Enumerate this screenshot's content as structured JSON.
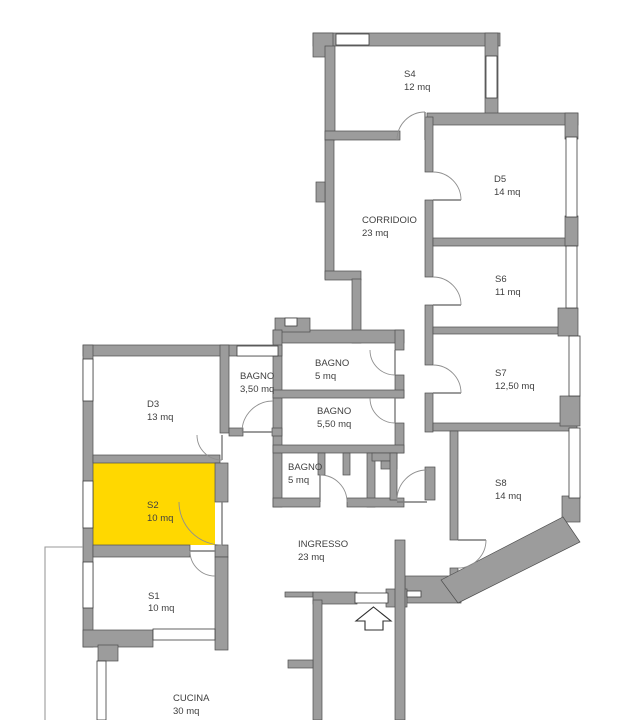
{
  "title": "Planimetria appartamento",
  "colors": {
    "wall": "#9c9c9c",
    "highlight": "#ffd800",
    "background": "#ffffff"
  },
  "highlighted_room": "S2",
  "unit_label": "mq",
  "rooms": [
    {
      "id": "s4",
      "name": "S4",
      "area": "12 mq"
    },
    {
      "id": "corridoio",
      "name": "CORRIDOIO",
      "area": "23 mq"
    },
    {
      "id": "d5",
      "name": "D5",
      "area": "14 mq"
    },
    {
      "id": "s6",
      "name": "S6",
      "area": "11 mq"
    },
    {
      "id": "s7",
      "name": "S7",
      "area": "12,50 mq"
    },
    {
      "id": "s8",
      "name": "S8",
      "area": "14 mq"
    },
    {
      "id": "d3",
      "name": "D3",
      "area": "13 mq"
    },
    {
      "id": "bagno-1",
      "name": "BAGNO",
      "area": "3,50 mq"
    },
    {
      "id": "bagno-2",
      "name": "BAGNO",
      "area": "5 mq"
    },
    {
      "id": "bagno-3",
      "name": "BAGNO",
      "area": "5,50 mq"
    },
    {
      "id": "bagno-4",
      "name": "BAGNO",
      "area": "5 mq"
    },
    {
      "id": "s2",
      "name": "S2",
      "area": "10 mq",
      "highlighted": true
    },
    {
      "id": "s1",
      "name": "S1",
      "area": "10 mq"
    },
    {
      "id": "ingresso",
      "name": "INGRESSO",
      "area": "23 mq"
    },
    {
      "id": "cucina",
      "name": "CUCINA",
      "area": "30 mq"
    }
  ]
}
